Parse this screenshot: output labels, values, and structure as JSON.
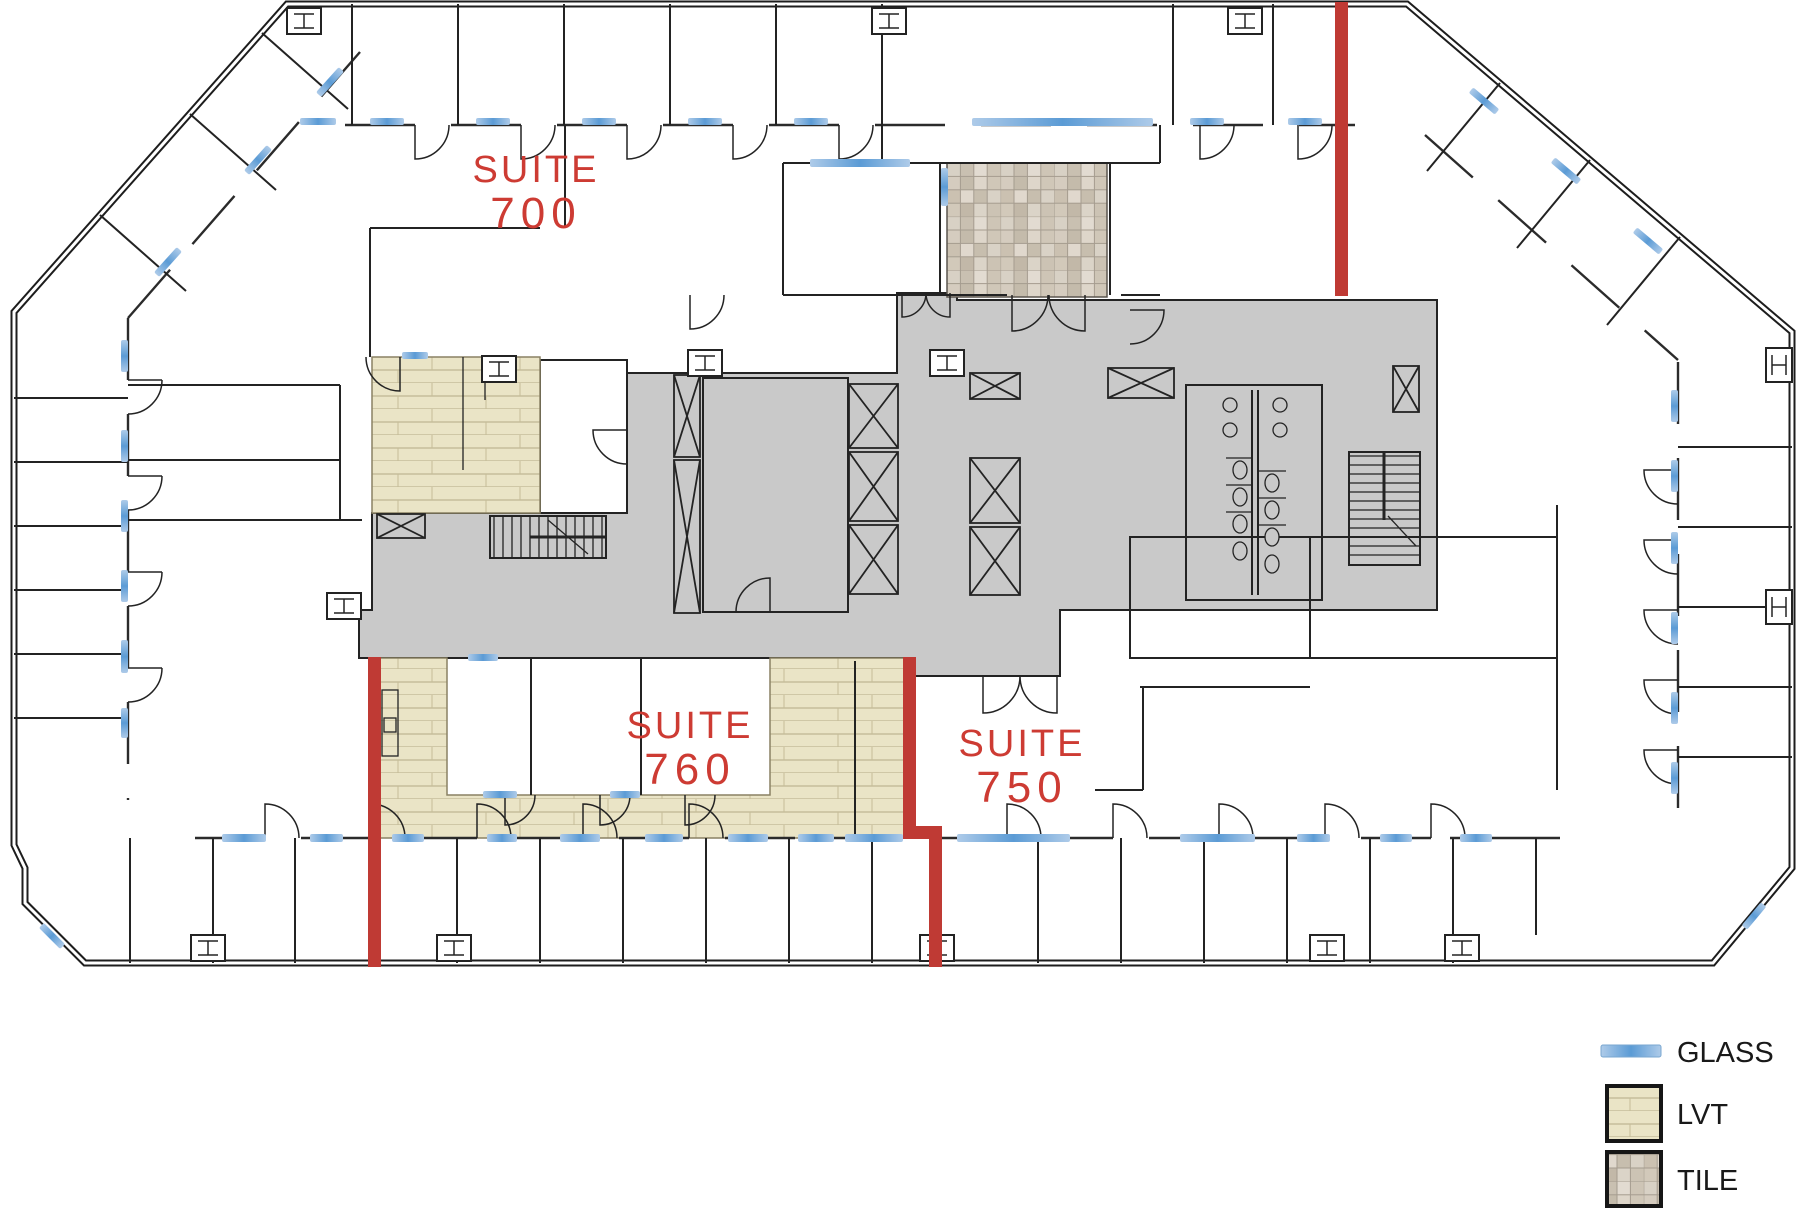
{
  "plan": {
    "suites": [
      {
        "id": "suite-700",
        "line1": "SUITE",
        "line2": "700"
      },
      {
        "id": "suite-760",
        "line1": "SUITE",
        "line2": "760"
      },
      {
        "id": "suite-750",
        "line1": "SUITE",
        "line2": "750"
      }
    ],
    "legend": {
      "items": [
        {
          "key": "glass",
          "label": "GLASS"
        },
        {
          "key": "lvt",
          "label": "LVT"
        },
        {
          "key": "tile",
          "label": "TILE"
        }
      ]
    },
    "colors": {
      "demising": "#bf3a34",
      "suite_label": "#cd3b33",
      "glass": "#5b9bd5",
      "core_fill": "#c9c9c9",
      "lvt_fill": "#e9e3c4",
      "tile_grout": "#a59c8f",
      "wall": "#232323"
    }
  }
}
